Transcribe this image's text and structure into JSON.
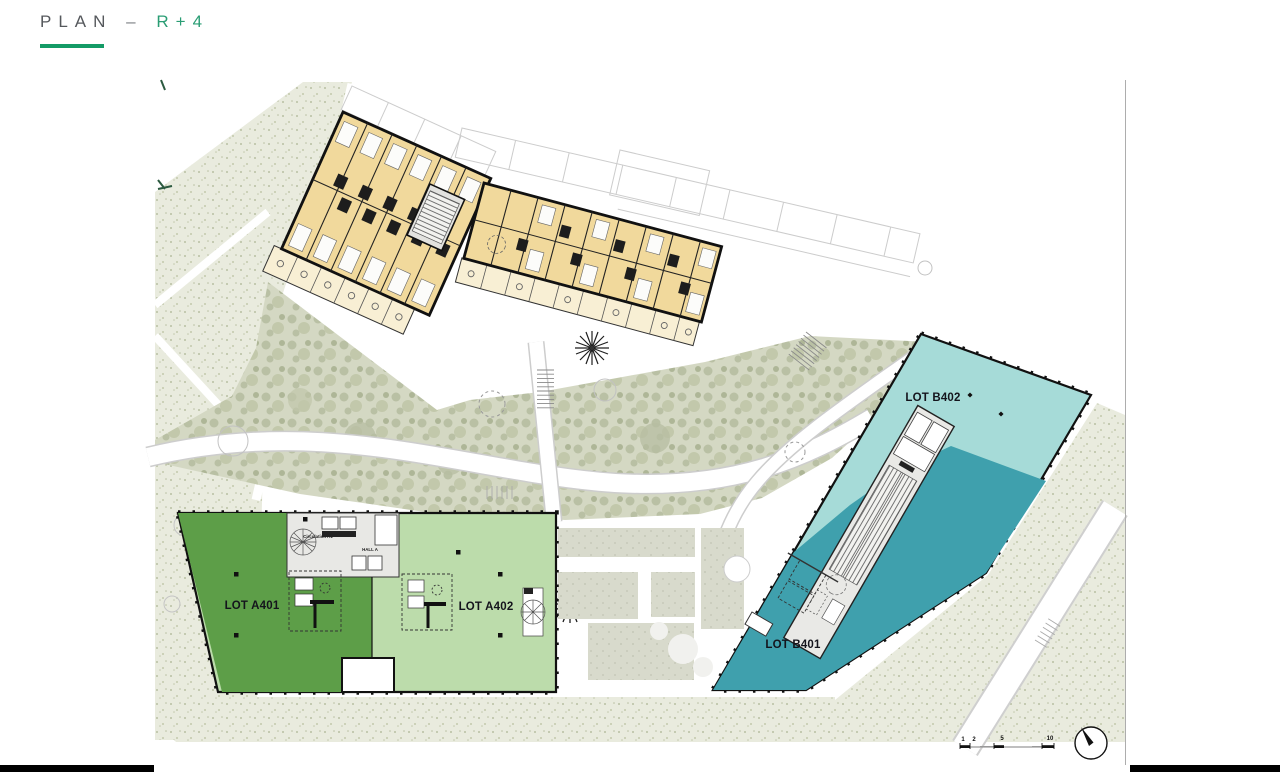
{
  "header": {
    "title": "PLAN",
    "separator": "–",
    "floor": "R+4",
    "accent_color": "#149b66"
  },
  "plan": {
    "lots": [
      {
        "id": "lot-a401",
        "label": "LOT A401",
        "color": "#5d9e48"
      },
      {
        "id": "lot-a402",
        "label": "LOT A402",
        "color": "#bcdcab"
      },
      {
        "id": "lot-b401",
        "label": "LOT B401",
        "color": "#3fa0ad"
      },
      {
        "id": "lot-b402",
        "label": "LOT B402",
        "color": "#a6dbd8"
      }
    ],
    "core_a": {
      "circulation": "Circulation A1",
      "hall": "HALL A"
    },
    "scale": {
      "ticks": [
        "1",
        "2",
        "5",
        "10"
      ]
    },
    "palette": {
      "residential": "#f1d99c",
      "balcony": "#f8efd4",
      "core_gray": "#e9e9e6",
      "landscape_speckle": "#e9ebde",
      "garden_olive": "#d4d8c3",
      "wall_black": "#111111"
    }
  }
}
